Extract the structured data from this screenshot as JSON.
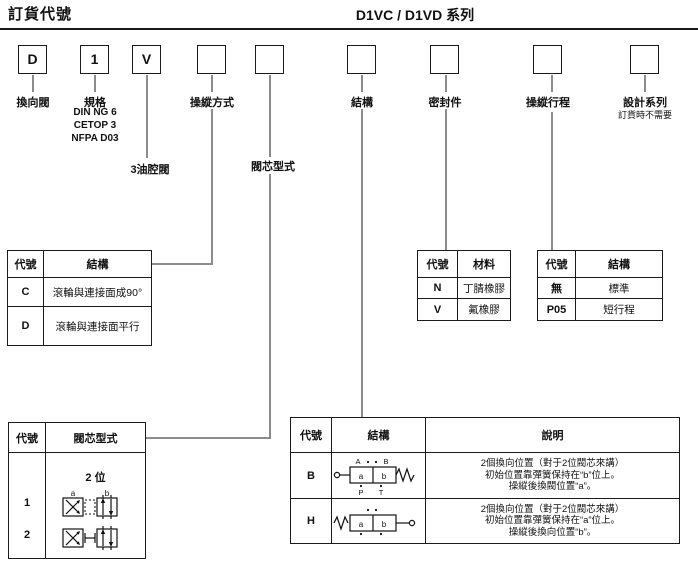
{
  "header": {
    "title_left": "訂貨代號",
    "title_right": "D1VC / D1VD 系列"
  },
  "code_boxes": {
    "b1": {
      "value": "D",
      "label": "換向閥"
    },
    "b2": {
      "value": "1",
      "label": "規格",
      "sub1": "DIN NG 6",
      "sub2": "CETOP 3",
      "sub3": "NFPA D03"
    },
    "b3": {
      "value": "V",
      "label": "3油腔閥"
    },
    "b4": {
      "value": "",
      "label": "操縱方式"
    },
    "b5": {
      "value": "",
      "label": "閥芯型式"
    },
    "b6": {
      "value": "",
      "label": "結構"
    },
    "b7": {
      "value": "",
      "label": "密封件"
    },
    "b8": {
      "value": "",
      "label": "操縱行程"
    },
    "b9": {
      "value": "",
      "label": "設計系列",
      "note": "訂貨時不需要"
    }
  },
  "operator_table": {
    "col_code": "代號",
    "col_desc": "結構",
    "rows": {
      "r1": {
        "code": "C",
        "desc": "滾輪與連接面成90°"
      },
      "r2": {
        "code": "D",
        "desc": "滾輪與連接面平行"
      }
    }
  },
  "seal_table": {
    "col_code": "代號",
    "col_desc": "材料",
    "rows": {
      "r1": {
        "code": "N",
        "desc": "丁腈橡膠"
      },
      "r2": {
        "code": "V",
        "desc": "氟橡膠"
      }
    }
  },
  "stroke_table": {
    "col_code": "代號",
    "col_desc": "結構",
    "rows": {
      "r1": {
        "code": "無",
        "desc": "標準"
      },
      "r2": {
        "code": "P05",
        "desc": "短行程"
      }
    }
  },
  "spool_table": {
    "col_code": "代號",
    "col_desc": "閥芯型式",
    "positions_label": "2 位",
    "rows": {
      "r1": {
        "code": "1",
        "port_a": "a",
        "port_b": "b"
      },
      "r2": {
        "code": "2"
      }
    }
  },
  "structure_table": {
    "col_code": "代號",
    "col_struct": "結構",
    "col_desc": "說明",
    "rows": {
      "rB": {
        "code": "B",
        "ports": {
          "A": "A",
          "B": "B",
          "P": "P",
          "T": "T",
          "a": "a",
          "b": "b"
        },
        "line1": "2個換向位置（對于2位閥芯來講）",
        "line2": "初始位置靠彈簧保持在“b”位上。",
        "line3": "操縱後換閥位置“a”。"
      },
      "rH": {
        "code": "H",
        "ports": {
          "a": "a",
          "b": "b"
        },
        "line1": "2個換向位置（對于2位閥芯來講）",
        "line2": "初始位置靠彈簧保持在“a”位上。",
        "line3": "操縱後換向位置“b”。"
      }
    }
  }
}
